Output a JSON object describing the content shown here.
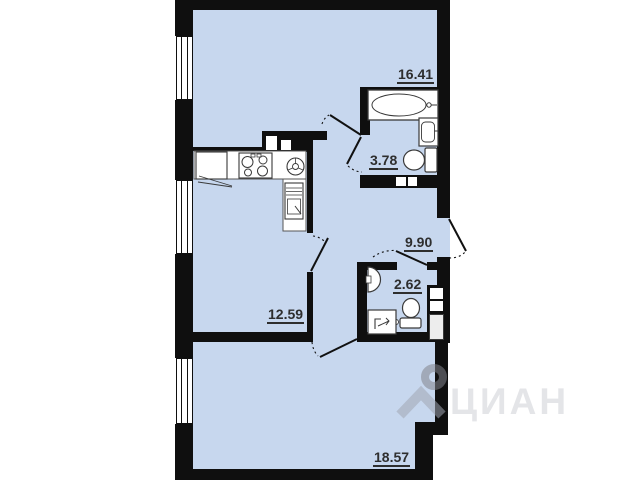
{
  "plan": {
    "type": "apartment-floor-plan",
    "rooms": [
      {
        "id": "living-room",
        "area": "16.41"
      },
      {
        "id": "bathroom",
        "area": "3.78"
      },
      {
        "id": "hallway",
        "area": "9.90"
      },
      {
        "id": "wc",
        "area": "2.62"
      },
      {
        "id": "kitchen",
        "area": "12.59"
      },
      {
        "id": "bedroom",
        "area": "18.57"
      }
    ],
    "fixtures": [
      "bathtub",
      "sink",
      "toilet",
      "corner-sink",
      "washing-machine",
      "fridge",
      "stove",
      "kitchen-sink",
      "cabinet"
    ],
    "colors": {
      "floor": "#c7d7ee",
      "wall": "#0f0f0f",
      "label": "#2e2e2e",
      "fixture_outline": "#3a3a3a"
    }
  },
  "watermark": {
    "text": "ЦИАН",
    "logo": "cian-pin-icon"
  }
}
